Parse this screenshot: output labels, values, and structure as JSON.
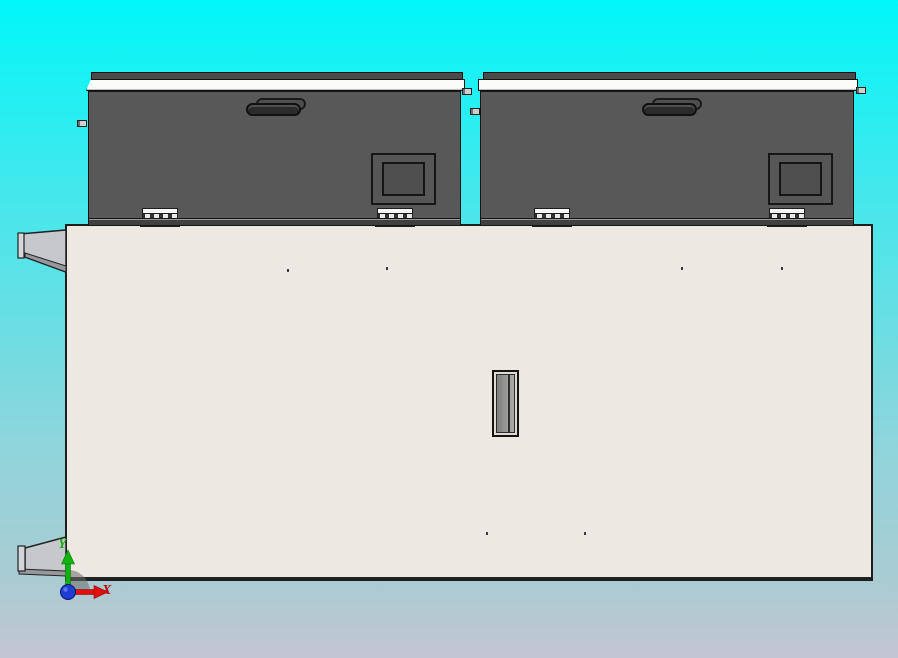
{
  "viewport": {
    "type": "cad-3d-view",
    "view_orientation": "side",
    "background_top_color": "#00F7F8",
    "background_bottom_color": "#C3C6D2"
  },
  "triad": {
    "x_label": "X",
    "y_label": "Y",
    "x_axis_color": "#C00000",
    "y_axis_color": "#12B212",
    "origin_sphere_color": "#1F3FD4",
    "arc_color": "#6E6E6E"
  },
  "model": {
    "body": {
      "part": "cabinet-body",
      "color": "#EDE9E2"
    },
    "lids": [
      {
        "part": "left-lid",
        "color": "#585858",
        "features": [
          "handle",
          "window",
          "hinge",
          "hinge",
          "top-rail"
        ]
      },
      {
        "part": "right-lid",
        "color": "#585858",
        "features": [
          "handle",
          "window",
          "hinge",
          "hinge",
          "top-rail"
        ]
      }
    ],
    "brackets": [
      {
        "part": "left-upper-bracket",
        "color": "#C7C8CC"
      },
      {
        "part": "left-lower-bracket",
        "color": "#C7C8CC"
      }
    ],
    "slot": {
      "part": "center-slot",
      "color": "#999998"
    }
  }
}
